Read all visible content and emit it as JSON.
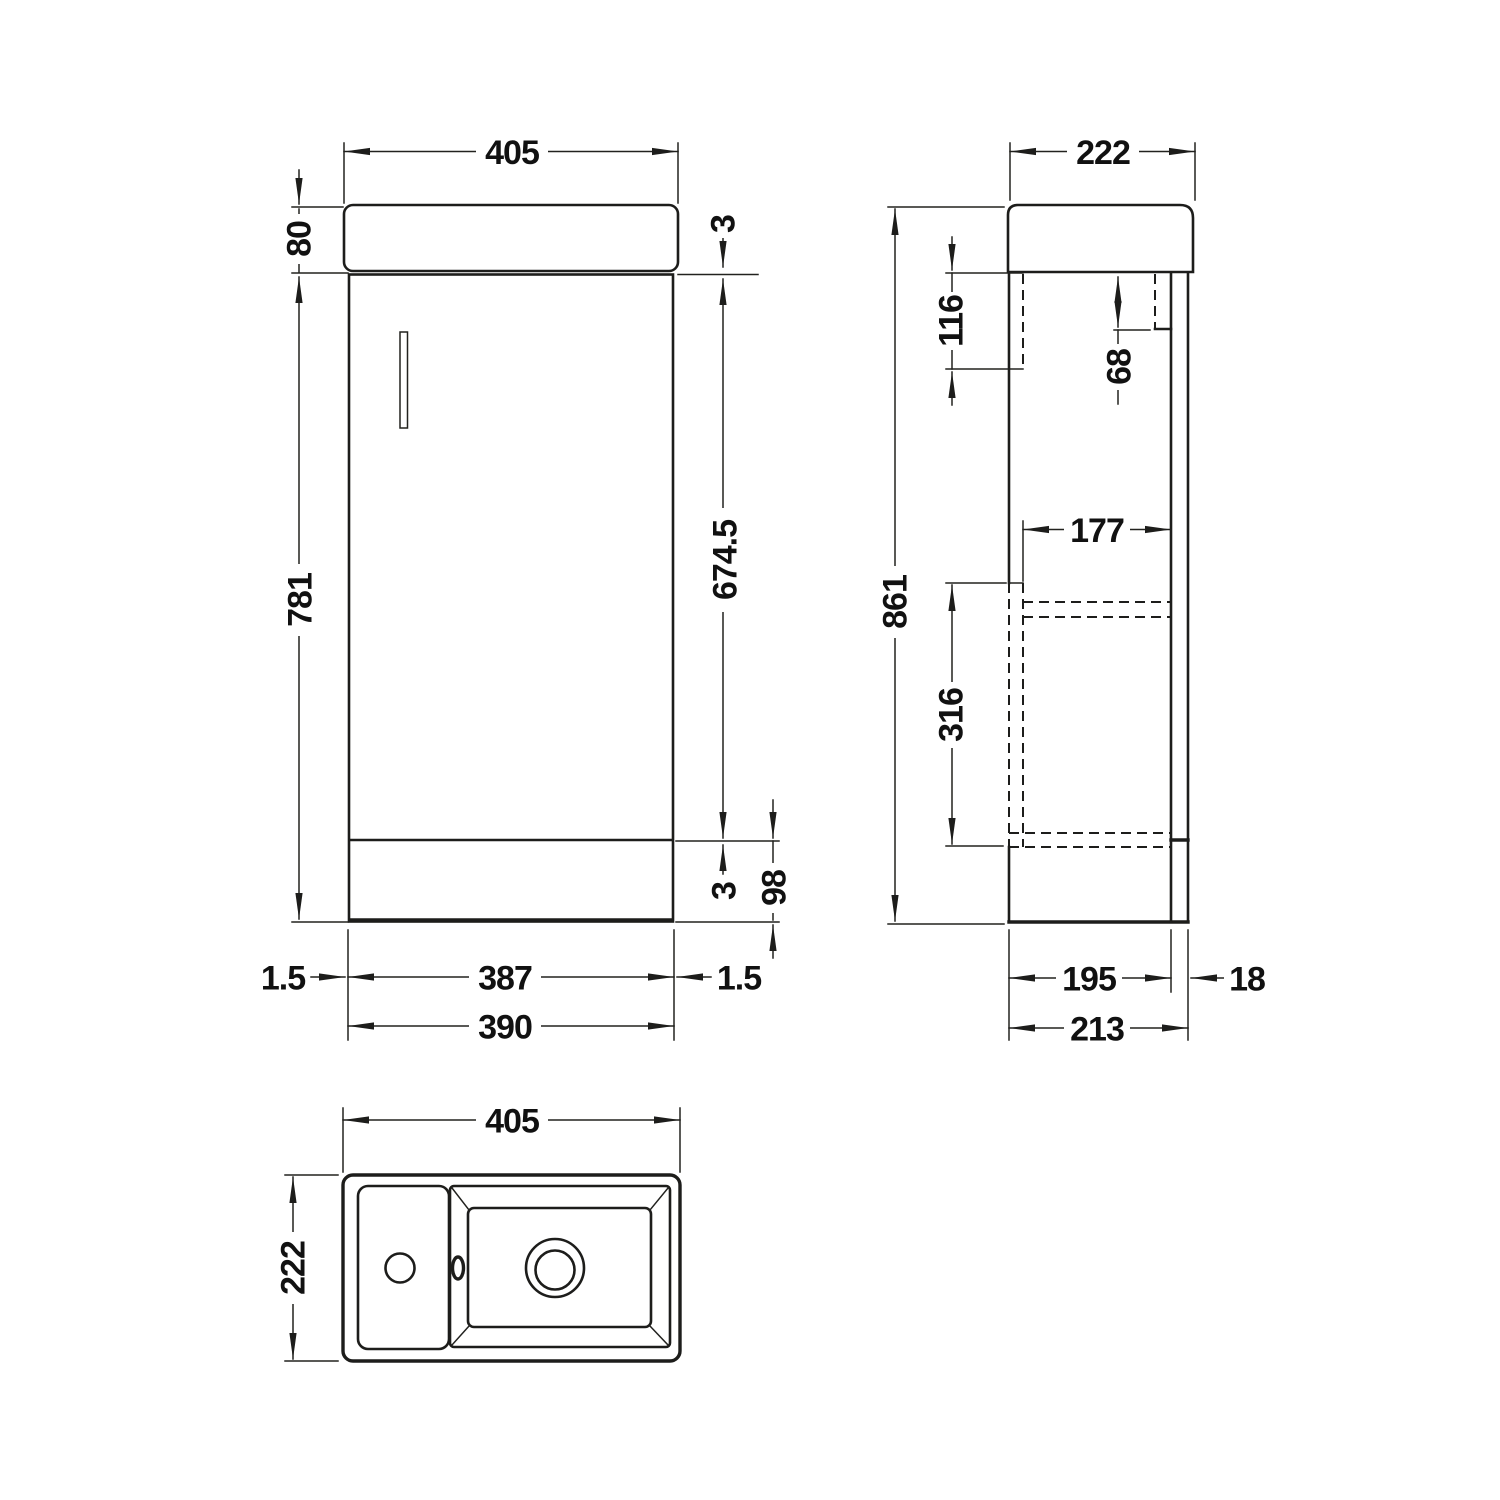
{
  "views": {
    "front": {
      "labels": {
        "basin_width": "405",
        "basin_height": "80",
        "top_gap": "3",
        "cabinet_height": "781",
        "door_height": "674.5",
        "bottom_gap": "3",
        "plinth_height": "98",
        "left_gap": "1.5",
        "door_width": "387",
        "right_gap": "1.5",
        "cabinet_width": "390"
      }
    },
    "side": {
      "labels": {
        "basin_depth": "222",
        "overall_height": "861",
        "hinge_top_offset": "116",
        "hinge_front_offset": "68",
        "internal_depth": "177",
        "internal_height": "316",
        "carcass_depth": "195",
        "door_thickness": "18",
        "overall_depth": "213"
      }
    },
    "plan": {
      "labels": {
        "width": "405",
        "depth": "222"
      }
    }
  },
  "colors": {
    "line": "#1d1d1b",
    "text": "#111111",
    "background": "#ffffff"
  }
}
